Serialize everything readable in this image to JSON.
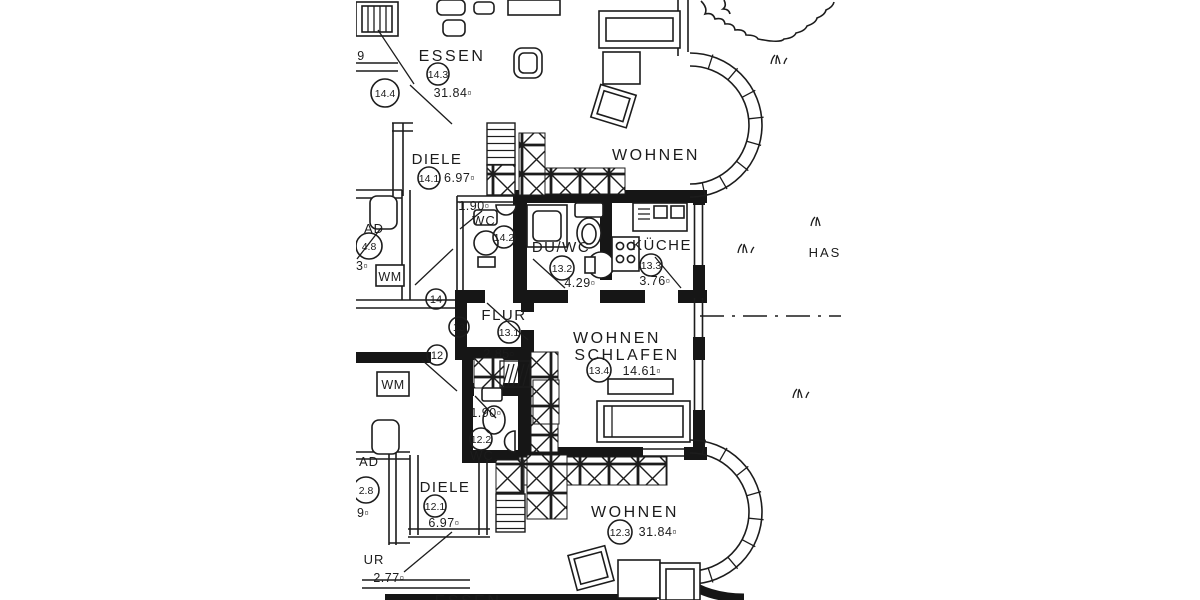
{
  "page": {
    "bg": "#ffffff",
    "ink": "#1c1c1c"
  },
  "plan": {
    "unit_top": {
      "essen": {
        "label": "ESSEN",
        "id": "14.3",
        "area": "31.84▫"
      },
      "wohnen": {
        "label": "WOHNEN"
      },
      "diele": {
        "label": "DIELE",
        "id": "14.1",
        "area": "6.97▫"
      },
      "wc": {
        "label": "WC",
        "id": "14.2",
        "dim": "1.90▫"
      },
      "bad": {
        "label": "AD",
        "id": "4.8",
        "dim": "3▫",
        "wm": "WM"
      },
      "side_id": "14.4",
      "edge_mark": "9"
    },
    "unit_mid": {
      "duwc": {
        "label": "DU/WC",
        "id": "13.2",
        "area": "4.29▫"
      },
      "kueche": {
        "label": "KÜCHE",
        "id": "13.3",
        "area": "3.76▫"
      },
      "flur": {
        "label": "FLUR",
        "id": "13.1",
        "area": "2.85▫"
      },
      "wohnen_schlafen": {
        "label1": "WOHNEN",
        "label2": "SCHLAFEN",
        "id": "13.4",
        "area": "14.61▫"
      },
      "bad_wm": "WM"
    },
    "unit_bottom": {
      "wc": {
        "label": "WC",
        "id": "12.2",
        "dim": "1.90▫"
      },
      "bad": {
        "label": "AD",
        "id": "2.8",
        "dim": "9▫"
      },
      "diele": {
        "label": "DIELE",
        "id": "12.1",
        "area": "6.97▫"
      },
      "flur": {
        "label": "UR",
        "dim": "2.77▫"
      },
      "essen": {
        "label": "ESSEN"
      },
      "wohnen": {
        "label": "WOHNEN",
        "id": "12.3",
        "area": "31.84▫"
      }
    },
    "stairwell": {
      "top": "14",
      "mid": "13",
      "bottom": "12"
    },
    "site": {
      "label": "HAS"
    }
  }
}
